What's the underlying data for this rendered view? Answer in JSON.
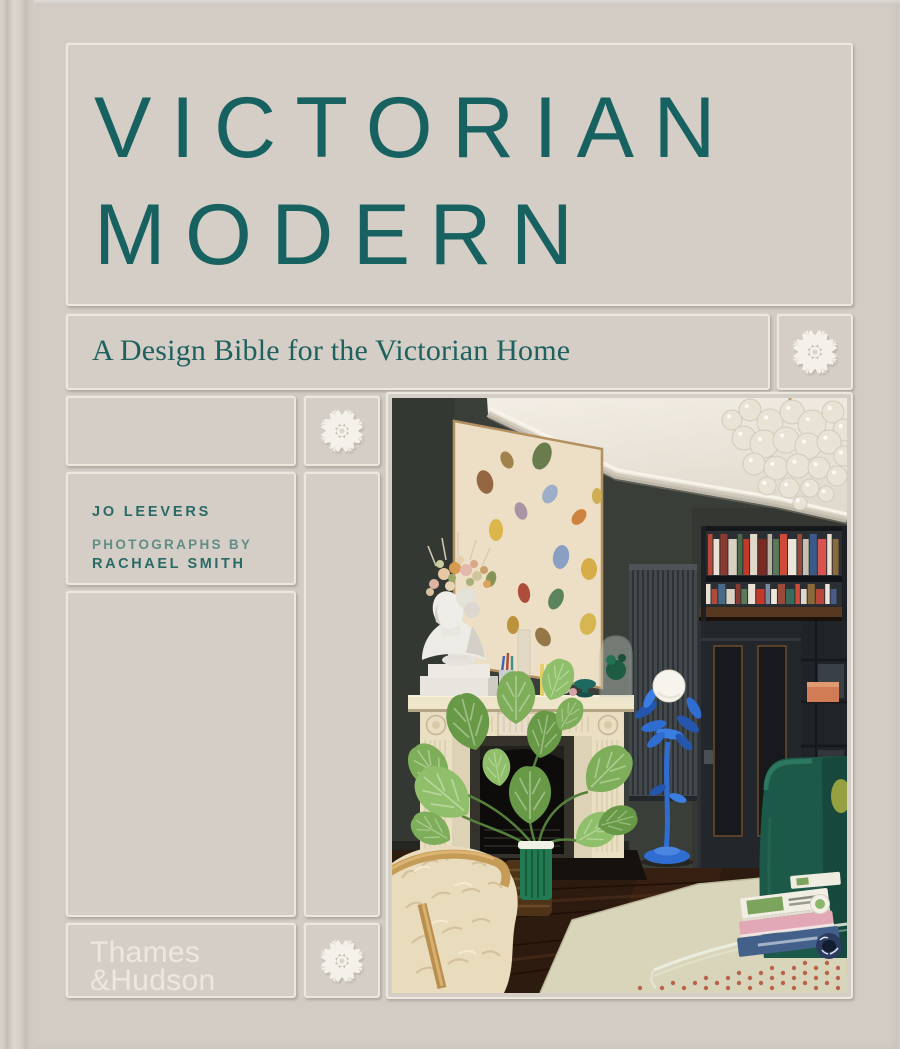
{
  "cover": {
    "title": {
      "line1": "VICTORIAN",
      "line2": "MODERN"
    },
    "subtitle": "A Design Bible for the Victorian Home",
    "credits": {
      "author": "JO LEEVERS",
      "photo_credit_prefix": "PHOTOGRAPHS BY",
      "photographer": "RACHAEL SMITH"
    },
    "publisher": {
      "line1": "Thames",
      "line2": "&Hudson"
    },
    "ornament_name": "ceiling-rose",
    "colors": {
      "cover_background": "#d2ccc5",
      "title_teal": "#176261",
      "subtitle_teal": "#1e615f",
      "author_teal": "#2a6a66",
      "credit_teal_light": "#4f817d",
      "publisher_text": "#edeae2",
      "ornament_white": "#f4f1ea"
    },
    "photo": {
      "description": "Victorian living room: dark green-grey walls, white ornate cornice and ceiling, glass bubble chandelier, large abstract painting with paint daubs, white carved marble fireplace, classical bust with dried-flower crown, mantel objects, built-in dark bookcase with colourful books over a panelled door, cobalt-blue floor lamp with white globe, monstera plant in green vase, cream sheepskin armchair, dark wood floor, pale rug, dark teal velvet sofa, glass coffee table with stacked books",
      "palette": {
        "wall": "#3a3e38",
        "ceiling": "#f0ebe2",
        "mantel": "#e7dcc0",
        "lamp_blue": "#2f6dd0",
        "plant_green": "#7fae5a",
        "sofa_green": "#1d5948",
        "floor_brown": "#2e1b10",
        "rug": "#d9d5ba",
        "painting_canvas": "#ecdfc5"
      }
    }
  },
  "photo_scene": {
    "chandelier_bubbles": [
      [
        340,
        22,
        10
      ],
      [
        358,
        12,
        11
      ],
      [
        378,
        24,
        13
      ],
      [
        400,
        14,
        12
      ],
      [
        420,
        26,
        14
      ],
      [
        441,
        14,
        11
      ],
      [
        452,
        32,
        11
      ],
      [
        352,
        40,
        12
      ],
      [
        372,
        46,
        14
      ],
      [
        394,
        42,
        13
      ],
      [
        416,
        48,
        13
      ],
      [
        437,
        44,
        12
      ],
      [
        452,
        58,
        10
      ],
      [
        362,
        66,
        11
      ],
      [
        384,
        70,
        12
      ],
      [
        406,
        68,
        12
      ],
      [
        427,
        70,
        11
      ],
      [
        445,
        78,
        10
      ],
      [
        375,
        88,
        9
      ],
      [
        397,
        90,
        10
      ],
      [
        418,
        90,
        9
      ],
      [
        434,
        96,
        8
      ],
      [
        408,
        105,
        7
      ]
    ],
    "painting_daubs": [
      [
        150,
        58,
        9,
        14,
        20,
        "#5e7242"
      ],
      [
        93,
        84,
        8,
        12,
        -15,
        "#8c5c36"
      ],
      [
        104,
        132,
        7,
        11,
        0,
        "#d9b23f"
      ],
      [
        158,
        96,
        7,
        10,
        30,
        "#96aac8"
      ],
      [
        129,
        113,
        6,
        9,
        -20,
        "#a38da0"
      ],
      [
        169,
        159,
        8,
        12,
        10,
        "#8099c2"
      ],
      [
        197,
        171,
        8,
        11,
        0,
        "#d4a83e"
      ],
      [
        132,
        195,
        6,
        10,
        -10,
        "#a8402e"
      ],
      [
        164,
        201,
        7,
        11,
        25,
        "#4e7c52"
      ],
      [
        187,
        119,
        6,
        9,
        40,
        "#cb7c34"
      ],
      [
        121,
        227,
        6,
        9,
        0,
        "#b78b30"
      ],
      [
        151,
        239,
        7,
        10,
        -30,
        "#8d6c3b"
      ],
      [
        99,
        181,
        5,
        8,
        15,
        "#7c8c4c"
      ],
      [
        205,
        98,
        5,
        8,
        0,
        "#ccaa4c"
      ],
      [
        196,
        226,
        8,
        11,
        15,
        "#d2b245"
      ],
      [
        115,
        62,
        6,
        9,
        -25,
        "#9a7a42"
      ]
    ],
    "shelf_rows": [
      {
        "x": 316,
        "bottom": 177,
        "max_h": 44,
        "colors": [
          "#b94a3a",
          "#e8e2d6",
          "#8a3a30",
          "#d9d2c2",
          "#4a6a4a",
          "#c0392b",
          "#e0d8c8",
          "#7a2a22",
          "#b8b0a0",
          "#5a7a5a",
          "#d04a38",
          "#ece6da",
          "#9a4a3a",
          "#c8c0b0",
          "#3a5a8a",
          "#d9534f",
          "#e8e0d0",
          "#8a6a3a",
          "#c84a3a",
          "#efe8da",
          "#d2691e"
        ]
      },
      {
        "x": 314,
        "bottom": 206,
        "max_h": 23,
        "colors": [
          "#e6e0d2",
          "#b04a3a",
          "#4a6a8a",
          "#d9d2c2",
          "#8a3a30",
          "#5a7a5a",
          "#e8e2d6",
          "#c0392b",
          "#7a8aa0",
          "#efe8da",
          "#9a4a3a",
          "#3a6a5a",
          "#d04a38",
          "#e0d8c8",
          "#8a6a3a",
          "#b8473a",
          "#ece6da",
          "#4a5a8a",
          "#c8c0b0"
        ]
      }
    ],
    "leaf_colors": [
      "#7fae5a",
      "#679947",
      "#8fbf6a"
    ],
    "monstera_leaves": [
      [
        52,
        390,
        1.0,
        -35,
        0
      ],
      [
        84,
        352,
        1.15,
        -15,
        1
      ],
      [
        124,
        326,
        1.05,
        0,
        0
      ],
      [
        158,
        302,
        0.85,
        20,
        2
      ],
      [
        76,
        416,
        1.25,
        -50,
        2
      ],
      [
        148,
        360,
        0.95,
        10,
        1
      ],
      [
        196,
        392,
        1.1,
        45,
        0
      ],
      [
        138,
        426,
        1.15,
        0,
        1
      ],
      [
        58,
        442,
        0.85,
        -60,
        0
      ],
      [
        184,
        444,
        0.9,
        60,
        2
      ],
      [
        108,
        388,
        0.75,
        -10,
        2
      ],
      [
        168,
        332,
        0.7,
        30,
        0
      ],
      [
        206,
        428,
        0.8,
        75,
        1
      ]
    ],
    "crown_flowers": [
      [
        42,
        186,
        5,
        "#dfb2a6"
      ],
      [
        52,
        176,
        6,
        "#e6c9a4"
      ],
      [
        63,
        170,
        6,
        "#d89a50"
      ],
      [
        74,
        172,
        6,
        "#e2b8ac"
      ],
      [
        85,
        178,
        5,
        "#cfc79b"
      ],
      [
        95,
        186,
        4,
        "#dba55b"
      ],
      [
        38,
        194,
        4,
        "#d7c29f"
      ],
      [
        48,
        166,
        4,
        "#c8ce9e"
      ],
      [
        68,
        162,
        4,
        "#e4cfae"
      ],
      [
        82,
        166,
        4,
        "#d8a889"
      ],
      [
        92,
        172,
        4,
        "#c9a06a"
      ],
      [
        58,
        188,
        5,
        "#e8d4b4"
      ],
      [
        60,
        180,
        4,
        "#9aa86a"
      ],
      [
        78,
        184,
        4,
        "#a8b07a"
      ]
    ]
  }
}
